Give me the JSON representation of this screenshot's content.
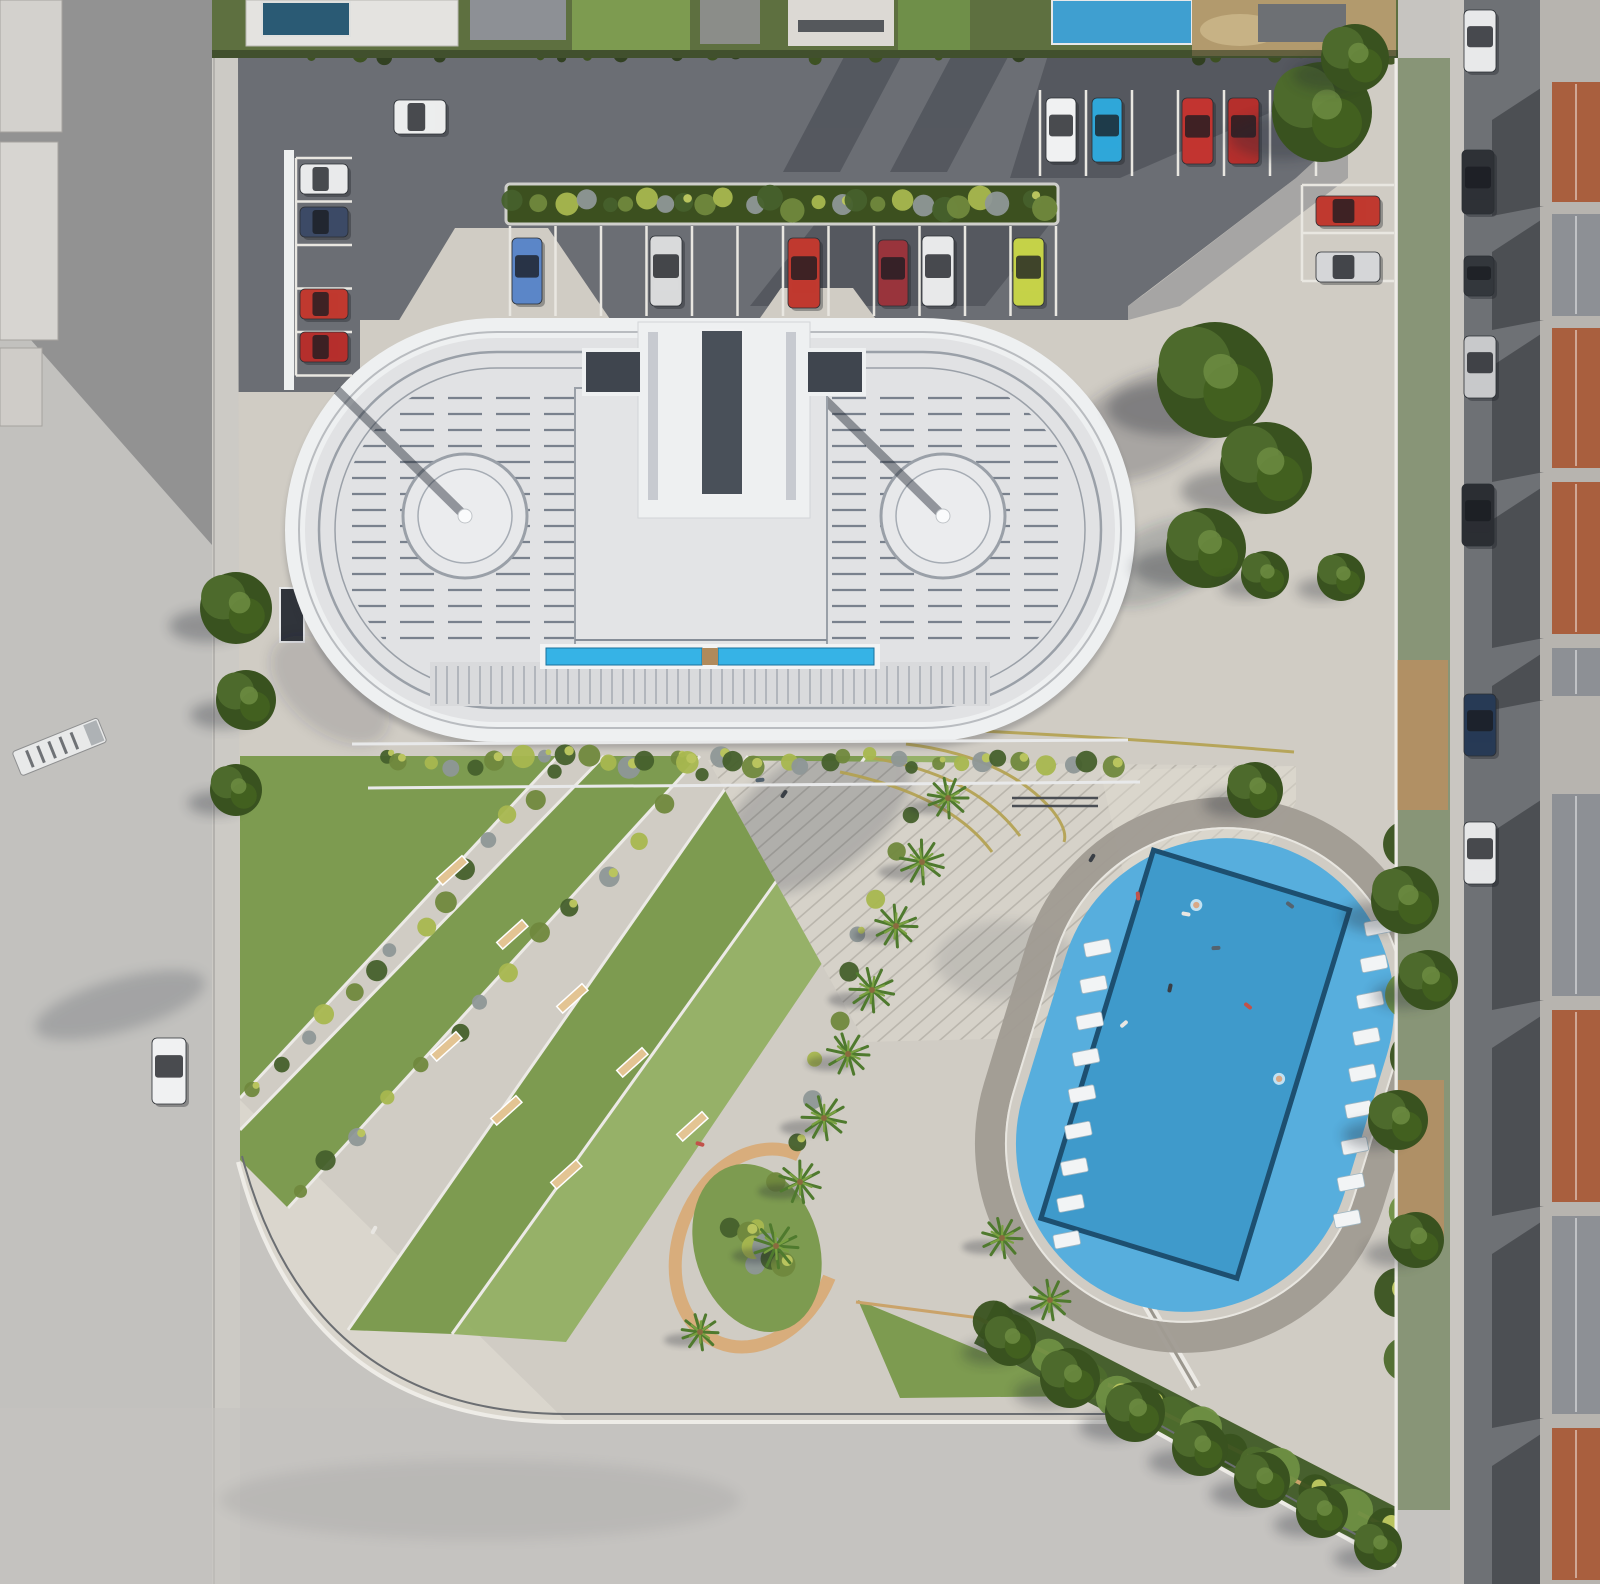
{
  "scene": {
    "title": "aerial-render-residential-complex",
    "canvas": {
      "width": 1600,
      "height": 1584
    },
    "palette": {
      "base_road": "#c6c4c0",
      "road_light": "#d0cdc8",
      "sidewalk": "#cccac5",
      "asphalt": "#6b6e74",
      "asphalt_light": "#7b7e84",
      "shadow_dark": "#232830",
      "plaza": "#d0ccc4",
      "plaza_bright": "#dcd8d0",
      "step_bg": "#d6d2c9",
      "step_line": "#bab6ad",
      "stall_line": "#e9e7e1",
      "hedge_base": "#5e7040",
      "lawn": "#7d9b50",
      "lawn_bright": "#8fae5e",
      "bush_dark": "#46602c",
      "bush_mid": "#70883d",
      "bush_light": "#a8b74f",
      "bush_gray": "#8e9797",
      "tree_dark": "#39521f",
      "tree_mid": "#4d6a2c",
      "tree_light": "#6f8f43",
      "palm": "#4f7a2e",
      "palm_light": "#79a040",
      "building_white": "#eef0f1",
      "roof_field": "#e1e2e4",
      "roof_ring": "#9aa0a8",
      "roof_stripe": "#79818d",
      "core_fill": "#e3e4e6",
      "slot_dark": "#495059",
      "wing_dark": "#3f454e",
      "strip_blue": "#36b3e6",
      "strip_blue_dark": "#19719c",
      "slat_line": "#aeb2b8",
      "pool_deck": "#57aedd",
      "pool_water": "#3f9acb",
      "pool_edge": "#1d4f70",
      "ring_path": "#a09b92",
      "lounger": "#f2f4f5",
      "tan_path": "#d8ad7c",
      "tan_edge": "#caa36a",
      "bench": "#e3c493",
      "lane_yellow": "#b3a14f",
      "terracotta": "#a95f3e",
      "roof_gray": "#8d9095",
      "house_wall": "#b7b4af",
      "street_asphalt": "#6e7175",
      "curb_white": "#eeece7",
      "dry_lot": "#b29a6d",
      "villa_pool": "#2a5a74",
      "villa_pool2": "#3f9fd0",
      "car_glass": "rgba(25,28,33,0.78)",
      "people_colors": [
        "#3a3f46",
        "#c2524a",
        "#e8e6e2",
        "#54636f"
      ]
    }
  },
  "building": {
    "stripes": {
      "x1": 352,
      "x2": 1068,
      "y0": 398,
      "dy": 16,
      "n": 16,
      "dash": "34 14"
    },
    "slats": {
      "x0": 436,
      "x1": 986,
      "dx": 11,
      "y1": 666,
      "y2": 704
    },
    "circle_pads": [
      {
        "cx": 465,
        "cy": 516
      },
      {
        "cx": 943,
        "cy": 516
      }
    ]
  },
  "parking": {
    "stall_groups": [
      {
        "type": "v",
        "x0": 510,
        "dx": 45.5,
        "n": 13,
        "y1": 226,
        "y2": 316
      },
      {
        "type": "v",
        "x0": 1040,
        "dx": 46,
        "n": 7,
        "y1": 90,
        "y2": 176
      },
      {
        "type": "h",
        "y0": 185,
        "dy": 48,
        "n": 3,
        "x1": 1302,
        "x2": 1394
      },
      {
        "type": "h",
        "y0": 158,
        "dy": 43.5,
        "n": 6,
        "x1": 296,
        "x2": 352
      }
    ]
  },
  "cars": [
    [
      512,
      238,
      30,
      66,
      "#5b86c8",
      "blue"
    ],
    [
      650,
      236,
      32,
      70,
      "#d9dadb",
      "silver"
    ],
    [
      788,
      238,
      32,
      70,
      "#c0392f",
      "red"
    ],
    [
      878,
      240,
      30,
      66,
      "#99343c",
      "maroon"
    ],
    [
      922,
      236,
      32,
      70,
      "#e8e9ea",
      "white"
    ],
    [
      1013,
      238,
      31,
      68,
      "#c5d248",
      "lime"
    ],
    [
      1046,
      98,
      30,
      64,
      "#f0f1f2",
      "white"
    ],
    [
      1092,
      98,
      30,
      64,
      "#2fa7d9",
      "cyan"
    ],
    [
      1182,
      98,
      31,
      66,
      "#c23430",
      "red"
    ],
    [
      1228,
      98,
      31,
      66,
      "#b52f2c",
      "red"
    ],
    [
      1316,
      196,
      64,
      30,
      "#c0392f",
      "red"
    ],
    [
      1316,
      252,
      64,
      30,
      "#d5d6d8",
      "silver"
    ],
    [
      300,
      164,
      48,
      30,
      "#e9eaeb",
      "white"
    ],
    [
      300,
      207,
      48,
      30,
      "#3c4a66",
      "darkblue"
    ],
    [
      300,
      289,
      48,
      30,
      "#c0392f",
      "red"
    ],
    [
      300,
      332,
      48,
      30,
      "#b52f2c",
      "red"
    ],
    [
      394,
      100,
      52,
      34,
      "#eceded",
      "white"
    ],
    [
      152,
      1038,
      34,
      66,
      "#f0f1f2",
      "white"
    ],
    [
      1464,
      10,
      32,
      62,
      "#e8e9ea",
      "white"
    ],
    [
      1462,
      150,
      32,
      64,
      "#2e3136",
      "black"
    ],
    [
      1464,
      256,
      30,
      40,
      "#33373c",
      "dark"
    ],
    [
      1464,
      336,
      32,
      62,
      "#c8c9cb",
      "silver"
    ],
    [
      1462,
      484,
      32,
      62,
      "#2b2e33",
      "black"
    ],
    [
      1464,
      694,
      32,
      62,
      "#273a55",
      "darkblue"
    ],
    [
      1464,
      822,
      32,
      62,
      "#e6e7e8",
      "white"
    ]
  ],
  "trees": [
    [
      1322,
      112,
      50
    ],
    [
      1355,
      58,
      34
    ],
    [
      1215,
      380,
      58
    ],
    [
      1266,
      468,
      46
    ],
    [
      1206,
      548,
      40
    ],
    [
      1265,
      575,
      24
    ],
    [
      1341,
      577,
      24
    ],
    [
      1255,
      790,
      28
    ],
    [
      236,
      608,
      36
    ],
    [
      246,
      700,
      30
    ],
    [
      236,
      790,
      26
    ],
    [
      1405,
      900,
      34
    ],
    [
      1428,
      980,
      30
    ],
    [
      1398,
      1120,
      30
    ],
    [
      1416,
      1240,
      28
    ],
    [
      1010,
      1340,
      26
    ],
    [
      1070,
      1378,
      30
    ],
    [
      1135,
      1412,
      30
    ],
    [
      1200,
      1448,
      28
    ],
    [
      1262,
      1480,
      28
    ],
    [
      1322,
      1512,
      26
    ],
    [
      1378,
      1546,
      24
    ]
  ],
  "palms": [
    [
      948,
      798,
      20
    ],
    [
      922,
      862,
      22
    ],
    [
      896,
      926,
      21
    ],
    [
      872,
      990,
      22
    ],
    [
      848,
      1054,
      21
    ],
    [
      824,
      1118,
      22
    ],
    [
      800,
      1182,
      21
    ],
    [
      776,
      1246,
      22
    ],
    [
      1002,
      1238,
      20
    ],
    [
      1050,
      1300,
      20
    ],
    [
      700,
      1332,
      18
    ]
  ],
  "bush_rows": [
    {
      "a": [
        520,
        204
      ],
      "b": [
        1046,
        204
      ],
      "n": 26,
      "r0": 7,
      "r1": 13,
      "set": 0
    },
    {
      "a": [
        382,
        762
      ],
      "b": [
        1116,
        760
      ],
      "n": 34,
      "r0": 6,
      "r1": 12,
      "set": 0
    },
    {
      "a": [
        1424,
        84
      ],
      "b": [
        1424,
        1556
      ],
      "n": 30,
      "r0": 13,
      "r1": 24,
      "set": 1
    },
    {
      "a": [
        992,
        1326
      ],
      "b": [
        1386,
        1528
      ],
      "n": 16,
      "r0": 13,
      "r1": 22,
      "set": 1
    },
    {
      "a": [
        560,
        772
      ],
      "b": [
        256,
        1094
      ],
      "n": 14,
      "r0": 6,
      "r1": 11,
      "set": 0
    },
    {
      "a": [
        700,
        772
      ],
      "b": [
        300,
        1198
      ],
      "n": 14,
      "r0": 6,
      "r1": 11,
      "set": 0
    },
    {
      "a": [
        905,
        812
      ],
      "b": [
        748,
        1262
      ],
      "n": 12,
      "r0": 7,
      "r1": 12,
      "set": 0
    },
    {
      "a": [
        18,
        420
      ],
      "b": [
        20,
        1300
      ],
      "n": 12,
      "r0": 14,
      "r1": 22,
      "set": 1
    },
    {
      "a": [
        736,
        1226
      ],
      "b": [
        778,
        1270
      ],
      "n": 6,
      "r0": 9,
      "r1": 15,
      "set": 0
    },
    {
      "a": [
        630,
        26
      ],
      "b": [
        1392,
        24
      ],
      "n": 15,
      "r0": 12,
      "r1": 22,
      "set": 1
    },
    {
      "a": [
        218,
        52
      ],
      "b": [
        1394,
        52
      ],
      "n": 42,
      "r0": 4,
      "r1": 8,
      "set": 2
    },
    {
      "a": [
        1412,
        840
      ],
      "b": [
        1406,
        1360
      ],
      "n": 8,
      "r0": 17,
      "r1": 27,
      "set": 1
    }
  ],
  "benches": [
    [
      452,
      870,
      -42
    ],
    [
      512,
      934,
      -42
    ],
    [
      572,
      998,
      -42
    ],
    [
      446,
      1046,
      -42
    ],
    [
      506,
      1110,
      -42
    ],
    [
      632,
      1062,
      -42
    ],
    [
      692,
      1126,
      -42
    ],
    [
      566,
      1174,
      -42
    ]
  ],
  "steps": {
    "n": 44,
    "y0": -290,
    "dy": 13.2,
    "angle": -41,
    "cx": 1000,
    "cy": 900
  },
  "pool": {
    "cx": 1205,
    "cy": 1075,
    "angle": 17,
    "deck": {
      "x": -168,
      "y": -240,
      "w": 336,
      "h": 480,
      "r": 168
    },
    "water": {
      "x": -115,
      "y": -200,
      "w": 205,
      "h": 385
    },
    "lounger_rows": [
      {
        "x": 122,
        "y": -192,
        "dx": 7,
        "dy": 36,
        "n": 9,
        "rot": -28,
        "w": 26,
        "h": 14
      },
      {
        "x": -140,
        "y": -90,
        "dx": 7,
        "dy": 36,
        "n": 9,
        "rot": -28,
        "w": 26,
        "h": 14
      }
    ],
    "swimmers": [
      [
        -58,
        -160
      ],
      [
        72,
        -18
      ]
    ]
  },
  "houses": [
    [
      78,
      128,
      "terracotta"
    ],
    [
      210,
      110,
      "roof_gray"
    ],
    [
      324,
      148,
      "terracotta"
    ],
    [
      478,
      160,
      "terracotta"
    ],
    [
      644,
      56,
      "roof_gray"
    ],
    [
      790,
      210,
      "roof_gray"
    ],
    [
      1006,
      200,
      "terracotta"
    ],
    [
      1212,
      206,
      "roof_gray"
    ],
    [
      1424,
      160,
      "terracotta"
    ]
  ],
  "people": [
    [
      1092,
      858
    ],
    [
      1138,
      896
    ],
    [
      1186,
      914
    ],
    [
      1216,
      948
    ],
    [
      1170,
      988
    ],
    [
      1248,
      1006
    ],
    [
      1124,
      1024
    ],
    [
      760,
      780
    ],
    [
      784,
      794
    ],
    [
      700,
      1144
    ],
    [
      374,
      1230
    ],
    [
      1290,
      905
    ]
  ]
}
